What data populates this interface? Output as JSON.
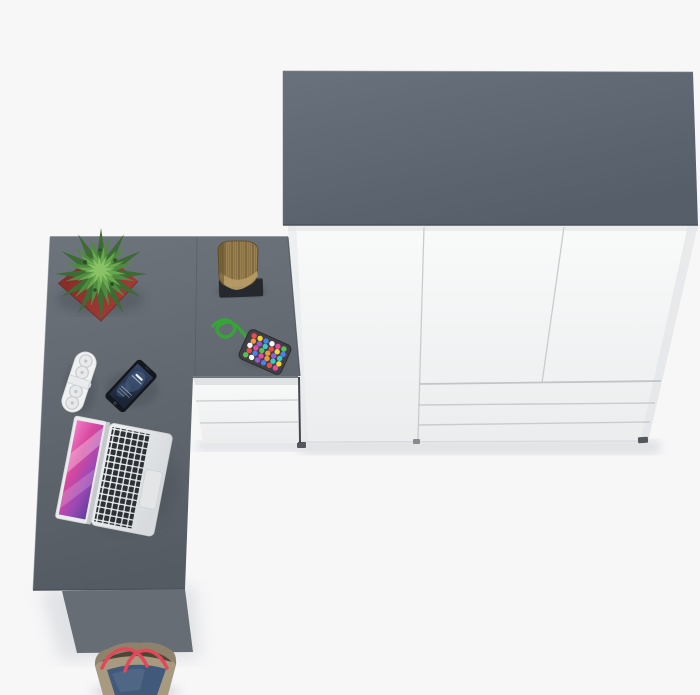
{
  "meta": {
    "title": "Top view product render of home office furniture set",
    "view": "top-down render",
    "objects": {
      "wardrobe": "three-door wardrobe with three lower drawers, white fronts, grey top panel",
      "desk": "L-shaped grey desk with white three-drawer pedestal and grey side panel leg",
      "plant": "green spiky potted plant in red cube pot",
      "wood-log": "decorative wooden log on black plinth",
      "bead-toy": "green cord with multicolored bead pad",
      "remote-speaker": "white pill-shaped remote speaker",
      "smartphone": "black smartphone with blue lock screen",
      "laptop": "open silver laptop with pink-purple wallpaper, dark keys, trackpad",
      "tote-bag": "beige and denim tote bag with red straps on floor"
    }
  },
  "palette": {
    "page_bg": "#f7f7f8",
    "shadow_soft": "#c9ccd1",
    "obj_shadow": "#3f454d",
    "wardrobe_top_light": "#69717c",
    "wardrobe_top_dark": "#565e69",
    "edge_dark": "#4b525b",
    "edge_light": "#7b838c",
    "white_hi": "#f9fafa",
    "white_lo": "#ebedee",
    "white_shade": "#e4e6e8",
    "seam": "#c9ccce",
    "gap_dark": "#42474d",
    "foot": "#54585d",
    "desk_light": "#6e747c",
    "desk_dark": "#555b63",
    "desk_panel": "#666d75",
    "module_seam": "#51575f",
    "pot_light": "#aa3d37",
    "pot_dark": "#7e2a27",
    "plant_dark": "#3c6b33",
    "plant_mid": "#4f8a40",
    "plant_light": "#6aa84f",
    "plant_tip": "#8cc267",
    "plant_dot": "#2b4f26",
    "log_wood": "#9a8050",
    "log_dark": "#6e5832",
    "log_mid": "#8a7142",
    "log_light": "#b79d67",
    "mat_black": "#25282c",
    "remote_body": "#f0f1f2",
    "remote_detail": "#c9ccce",
    "remote_mid": "#e9ebec",
    "phone_body": "#14171c",
    "phone_screen_hi": "#35486a",
    "phone_screen_lo": "#1b2536",
    "phone_glow": "#5d79a0",
    "laptop_bezel": "#e9ebec",
    "deck_hi": "#eef0f1",
    "deck_lo": "#d8dbde",
    "key_dark": "#2d3136",
    "trackpad": "#e3e5e7",
    "scr1": "#f07ac6",
    "scr2": "#d8489e",
    "scr3": "#9b48b5",
    "scr4": "#60419b",
    "cord": "#36a437",
    "pad": "#3f4044",
    "beads": [
      "#e84c4c",
      "#f2d43c",
      "#4c7fe8",
      "#ffffff",
      "#e84c9f",
      "#58c050",
      "#f2953c",
      "#9b59d0",
      "#3cc8c8"
    ],
    "bag_body": "#a79a81",
    "bag_rim": "#8d8069",
    "bag_inner": "#4f4537",
    "bag_denim": "#41597a",
    "bag_strap": "#e2475a"
  }
}
